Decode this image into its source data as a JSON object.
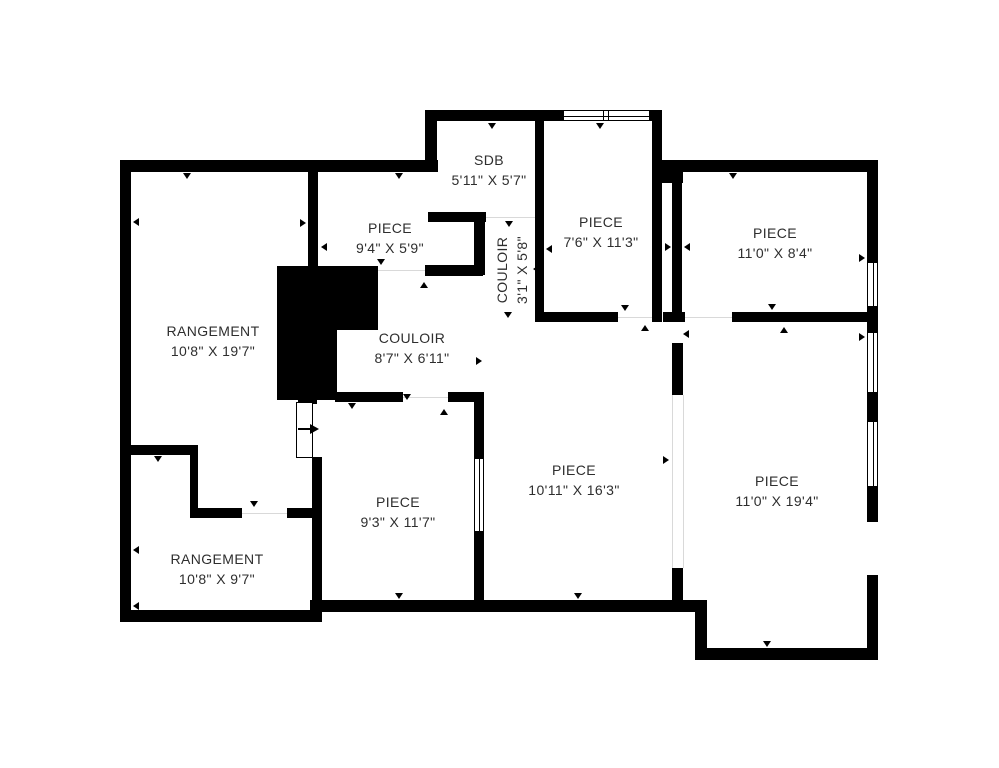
{
  "plan": {
    "title": "floor-plan",
    "canvas": {
      "width": 999,
      "height": 768,
      "background": "#ffffff"
    },
    "colors": {
      "wall": "#000000",
      "text": "#2e2e2e",
      "guide": "#d9d9d9"
    },
    "rooms": [
      {
        "name": "RANGEMENT",
        "dims": "10'8\" X 19'7\"",
        "cx": 213,
        "cy": 341,
        "vertical": false
      },
      {
        "name": "PIECE",
        "dims": "9'4\" X 5'9\"",
        "cx": 390,
        "cy": 238,
        "vertical": false
      },
      {
        "name": "SDB",
        "dims": "5'11\" X 5'7\"",
        "cx": 489,
        "cy": 170,
        "vertical": false
      },
      {
        "name": "COULOIR",
        "dims": "3'1\" X 5'8\"",
        "cx": 512,
        "cy": 270,
        "vertical": true
      },
      {
        "name": "PIECE",
        "dims": "7'6\" X 11'3\"",
        "cx": 601,
        "cy": 232,
        "vertical": false
      },
      {
        "name": "PIECE",
        "dims": "11'0\" X 8'4\"",
        "cx": 775,
        "cy": 243,
        "vertical": false
      },
      {
        "name": "COULOIR",
        "dims": "8'7\" X 6'11\"",
        "cx": 412,
        "cy": 348,
        "vertical": false
      },
      {
        "name": "RANGEMENT",
        "dims": "10'8\" X 9'7\"",
        "cx": 217,
        "cy": 569,
        "vertical": false
      },
      {
        "name": "PIECE",
        "dims": "9'3\" X 11'7\"",
        "cx": 398,
        "cy": 512,
        "vertical": false
      },
      {
        "name": "PIECE",
        "dims": "10'11\" X 16'3\"",
        "cx": 574,
        "cy": 480,
        "vertical": false
      },
      {
        "name": "PIECE",
        "dims": "11'0\" X 19'4\"",
        "cx": 777,
        "cy": 491,
        "vertical": false
      }
    ],
    "geometry": {
      "walls": [
        [
          425,
          110,
          138,
          11
        ],
        [
          650,
          110,
          12,
          11
        ],
        [
          425,
          110,
          12,
          62
        ],
        [
          652,
          110,
          10,
          212
        ],
        [
          120,
          160,
          318,
          12
        ],
        [
          658,
          160,
          220,
          12
        ],
        [
          120,
          160,
          11,
          462
        ],
        [
          120,
          610,
          202,
          12
        ],
        [
          310,
          600,
          387,
          12
        ],
        [
          695,
          600,
          12,
          60
        ],
        [
          695,
          648,
          183,
          12
        ],
        [
          867,
          160,
          11,
          102
        ],
        [
          867,
          307,
          11,
          25
        ],
        [
          867,
          393,
          11,
          28
        ],
        [
          867,
          487,
          11,
          35
        ],
        [
          867,
          575,
          11,
          85
        ],
        [
          535,
          118,
          9,
          204
        ],
        [
          428,
          212,
          58,
          10
        ],
        [
          474,
          216,
          11,
          59
        ],
        [
          425,
          265,
          58,
          11
        ],
        [
          308,
          170,
          10,
          98
        ],
        [
          543,
          312,
          75,
          10
        ],
        [
          662,
          168,
          21,
          15
        ],
        [
          672,
          180,
          10,
          132
        ],
        [
          663,
          312,
          22,
          10
        ],
        [
          732,
          312,
          146,
          10
        ],
        [
          672,
          343,
          11,
          52
        ],
        [
          672,
          568,
          11,
          44
        ],
        [
          474,
          392,
          10,
          66
        ],
        [
          474,
          532,
          10,
          80
        ],
        [
          335,
          392,
          68,
          10
        ],
        [
          448,
          392,
          36,
          10
        ],
        [
          120,
          445,
          73,
          10
        ],
        [
          190,
          445,
          8,
          67
        ],
        [
          190,
          508,
          52,
          10
        ],
        [
          287,
          508,
          33,
          10
        ],
        [
          312,
          457,
          10,
          155
        ]
      ],
      "solids": [
        [
          277,
          266,
          101,
          64
        ],
        [
          277,
          330,
          60,
          70
        ],
        [
          298,
          398,
          19,
          6
        ]
      ],
      "windows_h": [
        [
          563,
          110,
          87,
          11
        ]
      ],
      "windows_v": [
        [
          867,
          262,
          11,
          45
        ],
        [
          867,
          332,
          11,
          61
        ],
        [
          867,
          421,
          11,
          66
        ],
        [
          474,
          458,
          10,
          74
        ]
      ],
      "guides_v": [
        [
          672,
          395,
          173
        ],
        [
          683,
          395,
          173
        ]
      ],
      "guides_h": [
        [
          486,
          217,
          49
        ],
        [
          378,
          270,
          47
        ],
        [
          403,
          397,
          45
        ],
        [
          242,
          513,
          45
        ],
        [
          618,
          317,
          34
        ],
        [
          685,
          317,
          47
        ]
      ],
      "ticks": [
        [
          187,
          179,
          "down"
        ],
        [
          399,
          179,
          "down"
        ],
        [
          492,
          129,
          "down"
        ],
        [
          600,
          129,
          "down"
        ],
        [
          733,
          179,
          "down"
        ],
        [
          133,
          222,
          "left"
        ],
        [
          133,
          550,
          "left"
        ],
        [
          133,
          606,
          "left"
        ],
        [
          865,
          258,
          "right"
        ],
        [
          865,
          337,
          "right"
        ],
        [
          306,
          223,
          "right"
        ],
        [
          321,
          247,
          "left"
        ],
        [
          546,
          249,
          "left"
        ],
        [
          533,
          269,
          "left"
        ],
        [
          509,
          227,
          "down"
        ],
        [
          508,
          318,
          "down"
        ],
        [
          381,
          265,
          "down"
        ],
        [
          424,
          282,
          "up"
        ],
        [
          407,
          400,
          "down"
        ],
        [
          444,
          409,
          "up"
        ],
        [
          352,
          409,
          "down"
        ],
        [
          254,
          507,
          "down"
        ],
        [
          158,
          462,
          "down"
        ],
        [
          399,
          599,
          "down"
        ],
        [
          578,
          599,
          "down"
        ],
        [
          767,
          647,
          "down"
        ],
        [
          625,
          311,
          "down"
        ],
        [
          645,
          325,
          "up"
        ],
        [
          772,
          310,
          "down"
        ],
        [
          784,
          327,
          "up"
        ],
        [
          671,
          247,
          "right"
        ],
        [
          684,
          247,
          "left"
        ],
        [
          683,
          334,
          "left"
        ],
        [
          669,
          460,
          "right"
        ],
        [
          482,
          361,
          "right"
        ]
      ]
    },
    "entrance": {
      "leaf": [
        296,
        402,
        17,
        56
      ],
      "arrow_stem": [
        298,
        428,
        13,
        2
      ],
      "arrow_head": [
        310,
        424
      ]
    }
  }
}
